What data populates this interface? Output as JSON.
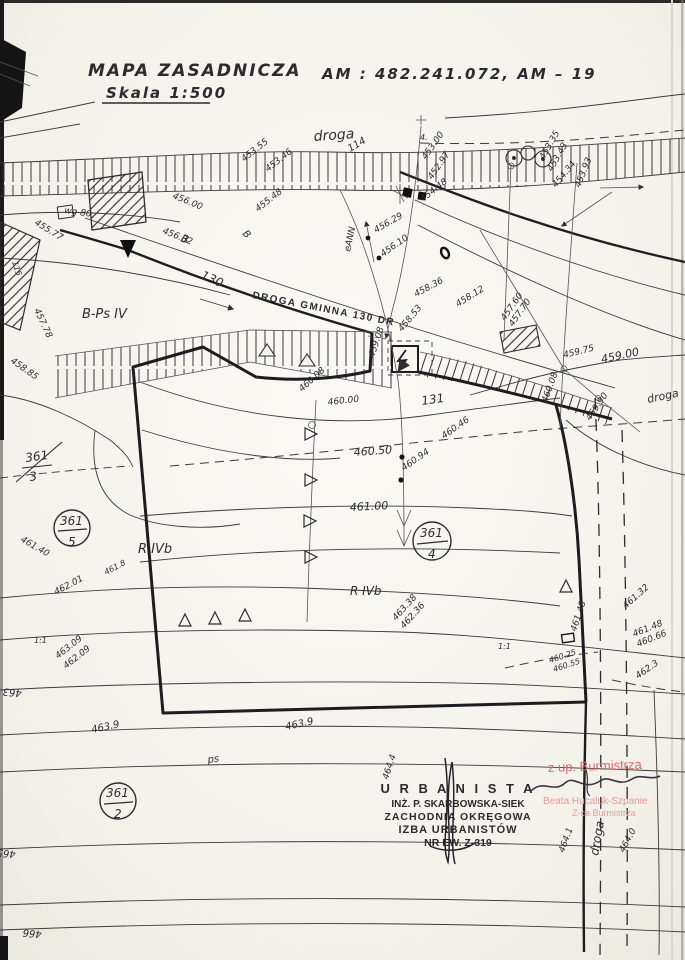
{
  "header": {
    "title": "MAPA  ZASADNICZA",
    "scale": "Skala 1:500",
    "sheet_ref": "AM : 482.241.072,   AM – 19"
  },
  "stamps": {
    "urbanista": {
      "line1": "U R B A N I S T A",
      "line2": "INŻ. P. SKARBOWSKA-SIEK",
      "line3": "ZACHODNIA OKRĘGOWA",
      "line4": "IZBA URBANISTÓW",
      "line5": "NR EW. Z-319"
    },
    "approval": {
      "line1": "z up. Burmistrza",
      "line2": "Beata Hucaluk-Szpanie",
      "line3": "Z-ca Burmistrza"
    }
  },
  "colors": {
    "ink": "#2f2d33",
    "paper": "#f5f3ed",
    "stamp_red": "#d96a6a",
    "stamp_red_light": "#e59c9c",
    "signature_ink": "#3a3540"
  },
  "map_labels": [
    {
      "t": "453.55",
      "x": 244,
      "y": 162,
      "r": -38
    },
    {
      "t": "453.46",
      "x": 268,
      "y": 172,
      "r": -38
    },
    {
      "t": "droga",
      "x": 314,
      "y": 141,
      "r": -4,
      "s": 14
    },
    {
      "t": "114",
      "x": 350,
      "y": 152,
      "r": -30,
      "s": 10
    },
    {
      "t": "4.",
      "x": 420,
      "y": 140,
      "r": 0,
      "s": 8
    },
    {
      "t": "453.00",
      "x": 426,
      "y": 160,
      "r": -55
    },
    {
      "t": "452.97",
      "x": 432,
      "y": 180,
      "r": -55
    },
    {
      "t": "454.48",
      "x": 423,
      "y": 202,
      "r": -38
    },
    {
      "t": "455.48",
      "x": 258,
      "y": 212,
      "r": -38
    },
    {
      "t": "453.35",
      "x": 544,
      "y": 160,
      "r": -60
    },
    {
      "t": "453.43",
      "x": 552,
      "y": 172,
      "r": -60
    },
    {
      "t": "454.34",
      "x": 556,
      "y": 188,
      "r": -50
    },
    {
      "t": "453.93",
      "x": 580,
      "y": 188,
      "r": -68
    },
    {
      "t": "456.00",
      "x": 172,
      "y": 198,
      "r": 22
    },
    {
      "t": "455.77",
      "x": 34,
      "y": 224,
      "r": 32
    },
    {
      "t": "wg 80",
      "x": 64,
      "y": 213,
      "r": 8
    },
    {
      "t": "456.32",
      "x": 162,
      "y": 233,
      "r": 22
    },
    {
      "t": "B",
      "x": 180,
      "y": 241,
      "r": 22,
      "s": 11
    },
    {
      "t": "B",
      "x": 242,
      "y": 234,
      "r": 45,
      "s": 10
    },
    {
      "t": "130",
      "x": 200,
      "y": 278,
      "r": 24,
      "s": 12
    },
    {
      "t": "B-Ps IV",
      "x": 82,
      "y": 318,
      "r": 0,
      "s": 13
    },
    {
      "t": "457.78",
      "x": 34,
      "y": 310,
      "r": 65
    },
    {
      "t": "115",
      "x": 12,
      "y": 262,
      "r": 72,
      "s": 8
    },
    {
      "t": "458.85",
      "x": 10,
      "y": 362,
      "r": 35
    },
    {
      "t": "DROGA GMINNA 130 DR",
      "x": 252,
      "y": 298,
      "r": 11,
      "s": 10,
      "b": true,
      "ls": 1.5,
      "it": false
    },
    {
      "t": "458.36",
      "x": 416,
      "y": 297,
      "r": -28
    },
    {
      "t": "458.53",
      "x": 402,
      "y": 332,
      "r": -50
    },
    {
      "t": "459.08",
      "x": 374,
      "y": 358,
      "r": -72
    },
    {
      "t": "460.08",
      "x": 302,
      "y": 392,
      "r": -42
    },
    {
      "t": "460.00",
      "x": 328,
      "y": 405,
      "r": -6
    },
    {
      "t": "131",
      "x": 422,
      "y": 405,
      "r": -8,
      "s": 12
    },
    {
      "t": "457.60",
      "x": 505,
      "y": 321,
      "r": -55
    },
    {
      "t": "457.70",
      "x": 513,
      "y": 327,
      "r": -55
    },
    {
      "t": "458.12",
      "x": 458,
      "y": 307,
      "r": -32
    },
    {
      "t": "459.75",
      "x": 564,
      "y": 358,
      "r": -14
    },
    {
      "t": "459.00",
      "x": 602,
      "y": 363,
      "r": -12,
      "s": 11
    },
    {
      "t": "460.08",
      "x": 547,
      "y": 403,
      "r": -70
    },
    {
      "t": "459.90",
      "x": 590,
      "y": 421,
      "r": -55
    },
    {
      "t": "droga",
      "x": 648,
      "y": 403,
      "r": -12,
      "s": 11
    },
    {
      "t": "eANN",
      "x": 350,
      "y": 252,
      "r": -78
    },
    {
      "t": "456.29",
      "x": 376,
      "y": 233,
      "r": -30
    },
    {
      "t": "456.10",
      "x": 383,
      "y": 257,
      "r": -35
    },
    {
      "t": "460.46",
      "x": 444,
      "y": 439,
      "r": -35
    },
    {
      "t": "460.50",
      "x": 354,
      "y": 456,
      "r": -4,
      "s": 11
    },
    {
      "t": "460.94",
      "x": 404,
      "y": 471,
      "r": -35
    },
    {
      "t": "461.00",
      "x": 350,
      "y": 511,
      "r": -3,
      "s": 11
    },
    {
      "t": "461.40",
      "x": 20,
      "y": 541,
      "r": 30
    },
    {
      "t": "R IVb",
      "x": 138,
      "y": 553,
      "r": 0,
      "s": 13
    },
    {
      "t": "R IVb",
      "x": 350,
      "y": 595,
      "r": 0,
      "s": 12
    },
    {
      "t": "461.8",
      "x": 106,
      "y": 575,
      "r": -28,
      "s": 8
    },
    {
      "t": "462.01",
      "x": 56,
      "y": 595,
      "r": -28
    },
    {
      "t": "463.38",
      "x": 396,
      "y": 621,
      "r": -48
    },
    {
      "t": "462.36",
      "x": 404,
      "y": 629,
      "r": -48
    },
    {
      "t": "1:1",
      "x": 34,
      "y": 643,
      "r": 0,
      "s": 8
    },
    {
      "t": "1:1",
      "x": 498,
      "y": 649,
      "r": 0,
      "s": 8
    },
    {
      "t": "463.09",
      "x": 58,
      "y": 659,
      "r": -38
    },
    {
      "t": "462.09",
      "x": 66,
      "y": 669,
      "r": -38
    },
    {
      "t": "463",
      "x": 22,
      "y": 690,
      "r": 185,
      "s": 10
    },
    {
      "t": "463.9",
      "x": 92,
      "y": 733,
      "r": -12,
      "s": 10
    },
    {
      "t": "463.9",
      "x": 286,
      "y": 730,
      "r": -12,
      "s": 10
    },
    {
      "t": "465",
      "x": 16,
      "y": 851,
      "r": 185,
      "s": 10
    },
    {
      "t": "466",
      "x": 42,
      "y": 931,
      "r": 185,
      "s": 10
    },
    {
      "t": "461.32",
      "x": 626,
      "y": 609,
      "r": -42
    },
    {
      "t": "461.48",
      "x": 634,
      "y": 637,
      "r": -22
    },
    {
      "t": "460.66",
      "x": 638,
      "y": 647,
      "r": -22
    },
    {
      "t": "462.3",
      "x": 638,
      "y": 679,
      "r": -35
    },
    {
      "t": "461.48",
      "x": 576,
      "y": 632,
      "r": -72
    },
    {
      "t": "460.25",
      "x": 550,
      "y": 663,
      "r": -18,
      "s": 8
    },
    {
      "t": "460.55",
      "x": 554,
      "y": 672,
      "r": -18,
      "s": 8
    },
    {
      "t": "ps",
      "x": 208,
      "y": 763,
      "r": -8,
      "s": 10
    },
    {
      "t": "464.4",
      "x": 388,
      "y": 780,
      "r": -72
    },
    {
      "t": "464.1",
      "x": 564,
      "y": 853,
      "r": -70
    },
    {
      "t": "droga",
      "x": 598,
      "y": 856,
      "r": -80,
      "s": 12
    },
    {
      "t": "464.0",
      "x": 624,
      "y": 853,
      "r": -62
    },
    {
      "t": "361",
      "x": 60,
      "y": 525,
      "s": 12
    },
    {
      "t": "5",
      "x": 68,
      "y": 546,
      "s": 12
    },
    {
      "t": "361",
      "x": 420,
      "y": 537,
      "s": 12
    },
    {
      "t": "4",
      "x": 428,
      "y": 558,
      "s": 12
    },
    {
      "t": "361",
      "x": 106,
      "y": 797,
      "s": 12
    },
    {
      "t": "2",
      "x": 114,
      "y": 818,
      "s": 12
    },
    {
      "t": "361",
      "x": 26,
      "y": 462,
      "r": -8,
      "s": 12
    },
    {
      "t": "3",
      "x": 30,
      "y": 481,
      "r": -8,
      "s": 12
    }
  ]
}
